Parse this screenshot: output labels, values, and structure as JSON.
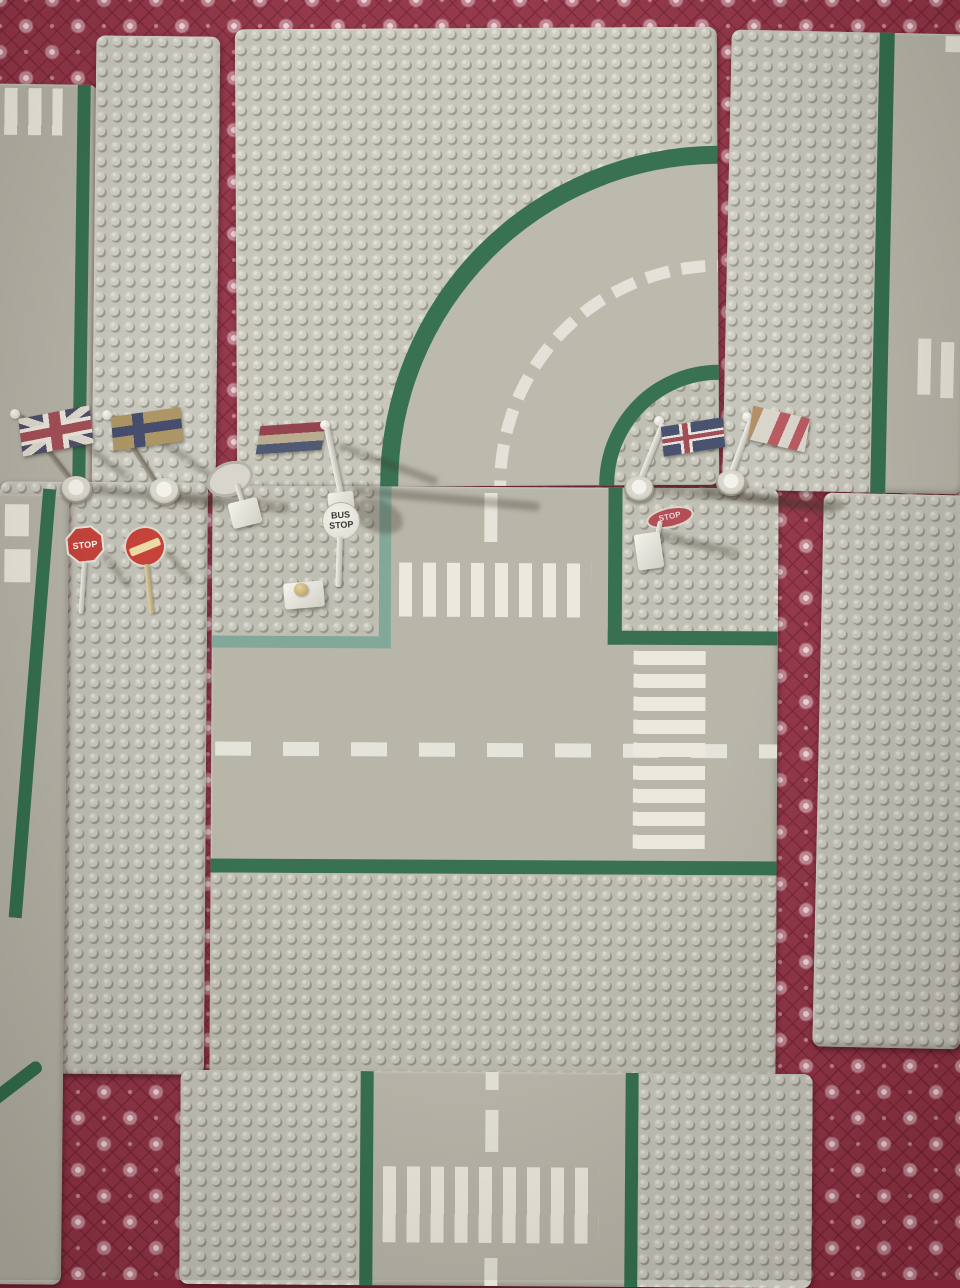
{
  "scene": {
    "description": "Photo of vintage grey LEGO road baseplates (curved road, T-junction, straight roads with crosswalks and plain stud strips) laid out on a dark red carpet with a pale floral diamond pattern; LEGO flags and road signs stand along the seams between plates.",
    "carpet_color": "#8e3043",
    "carpet_pattern_color": "#eecfd6",
    "plate_grey": "#c2c1b6",
    "road_grey": "#b5b3a6",
    "road_line_green": "#2e6b4a",
    "sidewalk_border_teal": "#7ba494",
    "road_marking_white": "#e8e6da"
  },
  "signs": {
    "bus_stop": {
      "line1": "BUS",
      "line2": "STOP",
      "shape": "round white sign on pole"
    },
    "stop_octagon": {
      "label": "STOP",
      "color": "#c23b33"
    },
    "stop_fallen": {
      "label": "STOP",
      "color": "#b0454e"
    },
    "no_entry": {
      "color": "#c2392e",
      "bar_color": "#ead9a2"
    },
    "blank_round": {
      "color": "#d6d4ca"
    }
  },
  "flags": {
    "union_jack": {
      "name": "United Kingdom",
      "colors": [
        "#474866",
        "#a04850",
        "#e8e4da"
      ]
    },
    "nordic_cross": {
      "name": "Nordic cross (faded tan with blue cross)",
      "colors": [
        "#a8905e",
        "#3d4566"
      ]
    },
    "netherlands": {
      "name": "Netherlands tricolour",
      "colors": [
        "#8e3a46",
        "#b5a88a",
        "#47516e"
      ]
    },
    "iceland": {
      "name": "Iceland",
      "colors": [
        "#3f4a68",
        "#e6e3d8",
        "#9c4550"
      ]
    },
    "union_jack_angled": {
      "name": "United Kingdom (seen at angle)",
      "colors": [
        "#d8d3c8",
        "#b6525a",
        "#b08a62"
      ]
    }
  },
  "plates": {
    "top_left_road": "road edge with crosswalk stripes",
    "top_left_strip": "plain stud strip",
    "top_curve": "curved road plate with dashed centre line",
    "top_right_road": "straight road plate",
    "bottom_left_strip": "plain stud strip",
    "left_road_edge": "road edge with crosswalk stripes",
    "t_junction": "T-junction road plate with two zebra crossings",
    "right_strip": "plain stud strip",
    "bottom_road": "straight road plate with zebra crossing"
  }
}
